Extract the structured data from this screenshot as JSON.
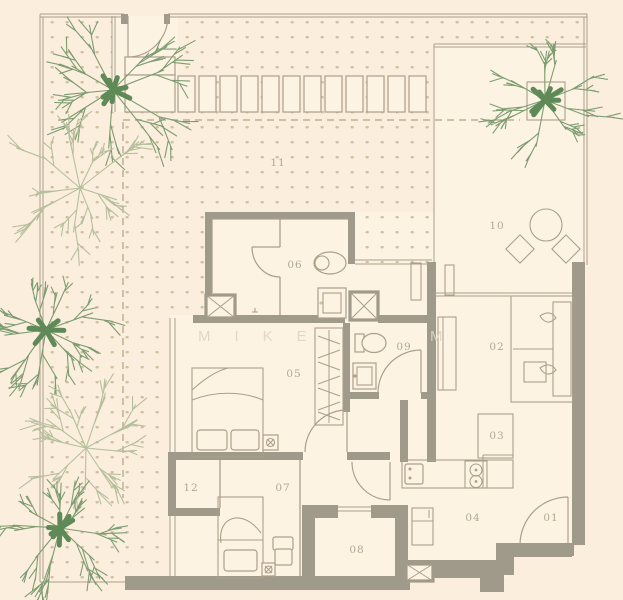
{
  "page": {
    "title": "Apartment floor plan"
  },
  "watermark": {
    "part1": "MIKE",
    "part2": "M"
  },
  "rooms": [
    {
      "id": "01"
    },
    {
      "id": "02"
    },
    {
      "id": "03"
    },
    {
      "id": "04"
    },
    {
      "id": "05"
    },
    {
      "id": "06"
    },
    {
      "id": "07"
    },
    {
      "id": "08"
    },
    {
      "id": "09"
    },
    {
      "id": "10"
    },
    {
      "id": "11"
    },
    {
      "id": "12"
    }
  ],
  "colors": {
    "background": "#fbeedc",
    "floor": "#fdf3e3",
    "wall": "#a09a8b",
    "line": "#ab9f8a",
    "dots": "#cfc2a2",
    "dash": "#bdb094",
    "label": "#b2a892",
    "watermark": "#e0d6c0",
    "tree_trunk": "#5f8a58",
    "tree_branch": "#7d9c72",
    "tree_light": "#b6bf9d"
  }
}
